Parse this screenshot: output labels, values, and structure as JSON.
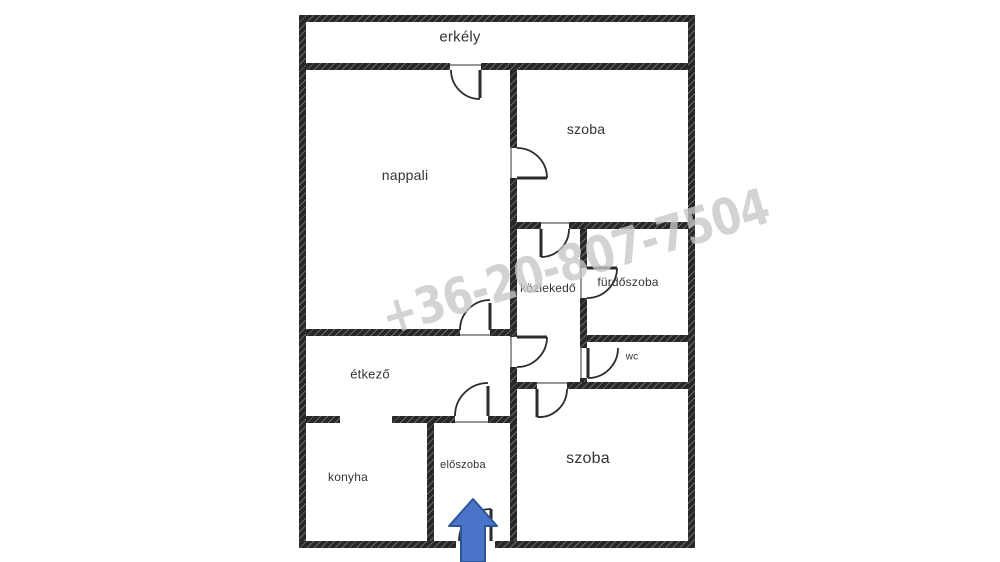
{
  "plan": {
    "rooms": {
      "erkely": {
        "label": "erkély"
      },
      "nappali": {
        "label": "nappali"
      },
      "szoba_felso": {
        "label": "szoba"
      },
      "kozlekedo": {
        "label": "közlekedő"
      },
      "furdoszoba": {
        "label": "fürdőszoba"
      },
      "wc": {
        "label": "wc"
      },
      "etkezo": {
        "label": "étkező"
      },
      "konyha": {
        "label": "konyha"
      },
      "eloszoba": {
        "label": "előszoba"
      },
      "szoba_also": {
        "label": "szoba"
      }
    },
    "watermark": {
      "text": "+36-20-807-7504",
      "color": "#c6c6c6"
    },
    "entrance_arrow": {
      "direction": "up",
      "color": "#4a74c8"
    }
  },
  "colors": {
    "background": "#ffffff",
    "wall": "#272727",
    "door_line": "#2b2b2b",
    "label_text": "#333333",
    "arrow_fill": "#4a74c8",
    "arrow_stroke": "#2d5699"
  }
}
